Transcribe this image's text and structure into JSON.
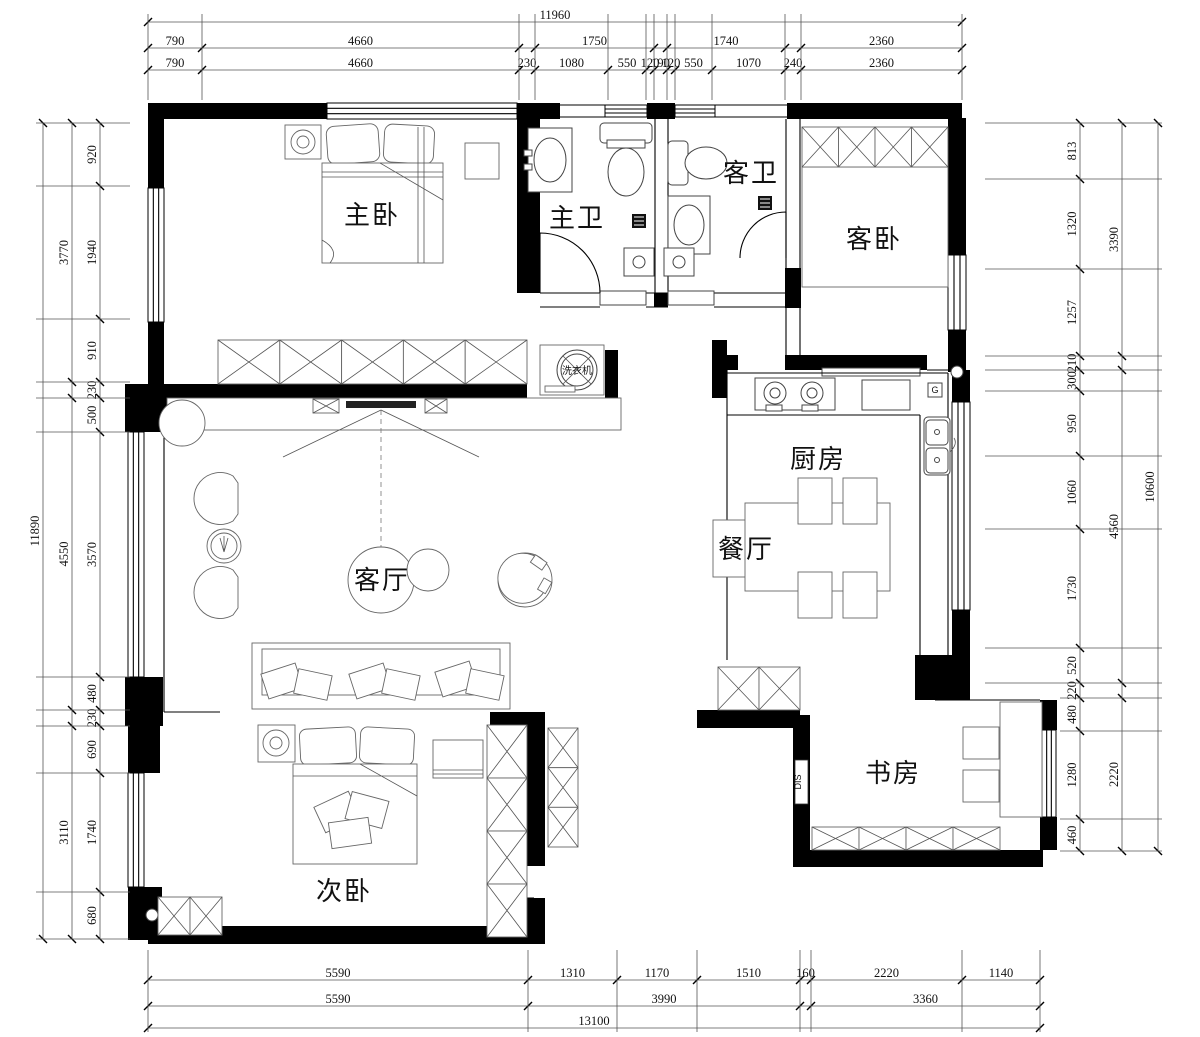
{
  "rooms": {
    "master_bedroom": "主卧",
    "master_bath": "主卫",
    "guest_bath": "客卫",
    "guest_bedroom": "客卧",
    "kitchen": "厨房",
    "dining": "餐厅",
    "living": "客厅",
    "second_bedroom": "次卧",
    "study": "书房"
  },
  "annotations": {
    "washer": "洗衣机",
    "dis": "DIS",
    "gas": "G"
  },
  "dimensions": {
    "top": {
      "overall": "11960",
      "row2": [
        "790",
        "4660",
        "1750",
        "1740",
        "2360"
      ],
      "row3": [
        "790",
        "4660",
        "230",
        "1080",
        "550",
        "120",
        "190",
        "120",
        "550",
        "1070",
        "240",
        "2360"
      ]
    },
    "bottom": {
      "row1": [
        "5590",
        "1310",
        "1170",
        "1510",
        "160",
        "2220",
        "1140"
      ],
      "row2": [
        "5590",
        "3990",
        "3360"
      ],
      "overall": "13100"
    },
    "left": {
      "overall": "11890",
      "mid": [
        "3770",
        "4550",
        "3110"
      ],
      "inner": [
        "920",
        "1940",
        "910",
        "230",
        "500",
        "3570",
        "480",
        "230",
        "690",
        "1740",
        "680"
      ]
    },
    "right": {
      "overall": "10600",
      "mid": [
        "3390",
        "4560",
        "2220"
      ],
      "inner": [
        "813",
        "1320",
        "1257",
        "210",
        "300",
        "950",
        "1060",
        "1730",
        "520",
        "220",
        "480",
        "1280",
        "460"
      ]
    }
  }
}
